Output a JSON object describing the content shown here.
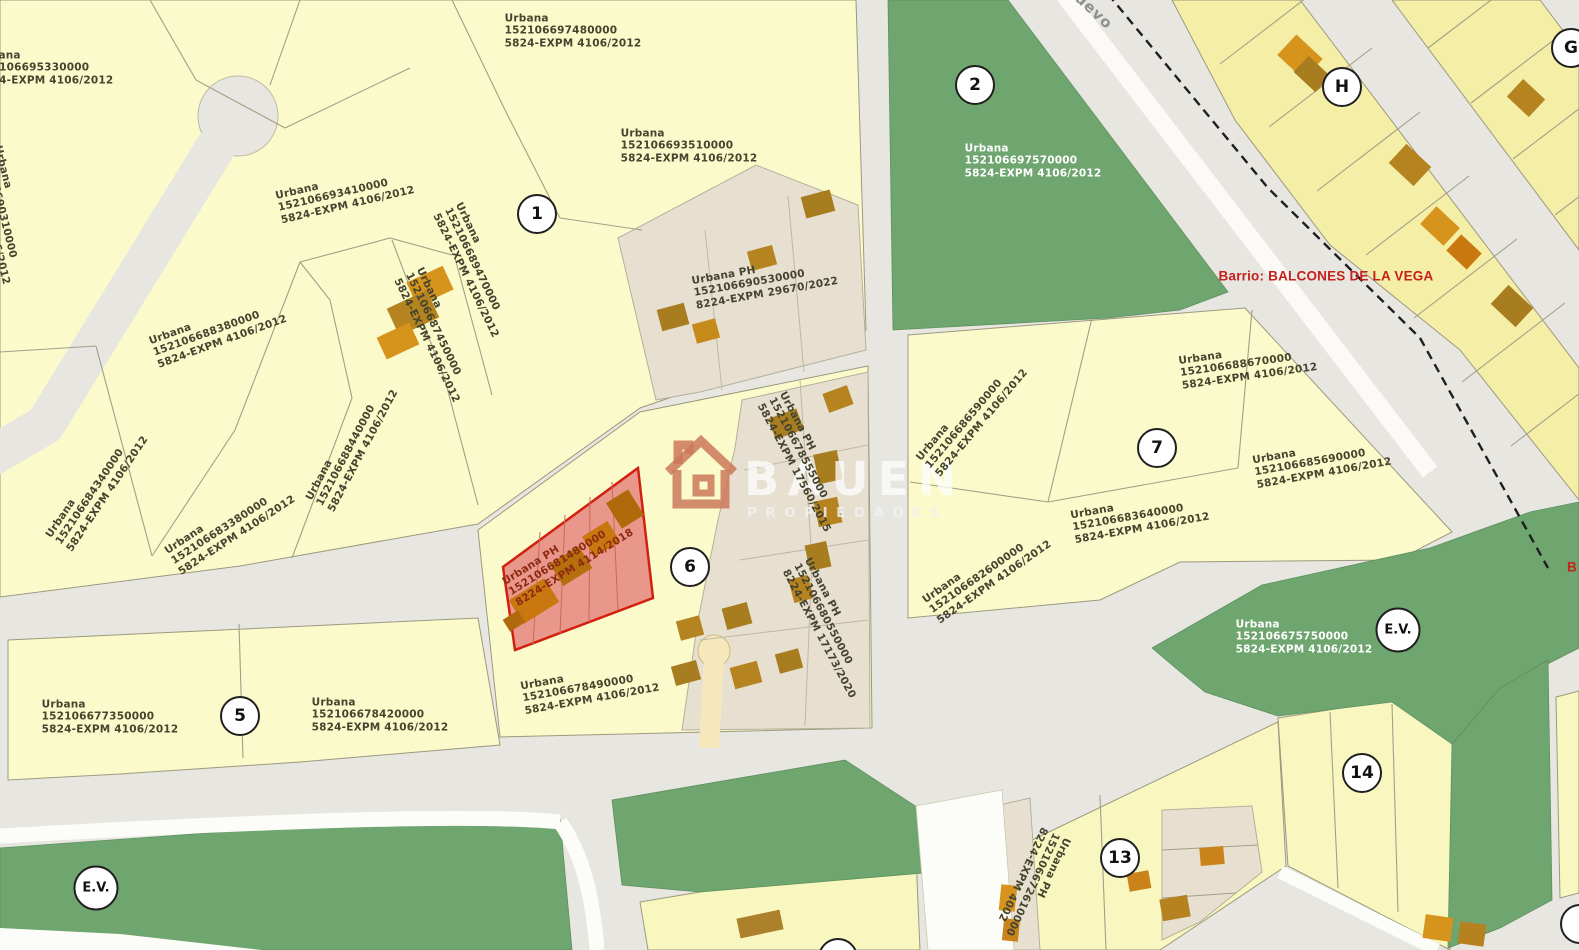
{
  "map": {
    "barrio_label": "Barrio: BALCONES DE LA VEGA",
    "barrio_label_partial": "B",
    "street_label_partial": "uevo",
    "watermark": {
      "brand": "BAUEN",
      "subtitle": "PROPIEDADES"
    },
    "highlight_color": "#d2200f",
    "parcel_fill": "#fbfacb",
    "green_fill": "#6fa56f",
    "circles": [
      {
        "label": "1"
      },
      {
        "label": "2"
      },
      {
        "label": "5"
      },
      {
        "label": "6"
      },
      {
        "label": "7"
      },
      {
        "label": "13"
      },
      {
        "label": "14"
      },
      {
        "label": "H"
      },
      {
        "label": "G"
      },
      {
        "label": "E.V."
      },
      {
        "label": "E.V."
      },
      {
        "label": ""
      },
      {
        "label": ""
      }
    ],
    "parcels": [
      {
        "l1": "Urbana",
        "l2": "152106695330000",
        "l3": "5824-EXPM 4106/2012"
      },
      {
        "l1": "Urbana",
        "l2": "152106690310000",
        "l3": "5824-EXPM 4106/2012"
      },
      {
        "l1": "5824-EXPM 4106/2012",
        "l2": "",
        "l3": ""
      },
      {
        "l1": "Urbana",
        "l2": "152106697480000",
        "l3": "5824-EXPM 4106/2012"
      },
      {
        "l1": "Urbana",
        "l2": "152106693510000",
        "l3": "5824-EXPM 4106/2012"
      },
      {
        "l1": "Urbana",
        "l2": "152106693410000",
        "l3": "5824-EXPM 4106/2012"
      },
      {
        "l1": "Urbana",
        "l2": "152106689470000",
        "l3": "5824-EXPM 4106/2012"
      },
      {
        "l1": "Urbana",
        "l2": "152106687450000",
        "l3": "5824-EXPM 4106/2012"
      },
      {
        "l1": "Urbana",
        "l2": "152106688380000",
        "l3": "5824-EXPM 4106/2012"
      },
      {
        "l1": "Urbana",
        "l2": "152106684340000",
        "l3": "5824-EXPM 4106/2012"
      },
      {
        "l1": "Urbana",
        "l2": "152106683380000",
        "l3": "5824-EXPM 4106/2012"
      },
      {
        "l1": "Urbana",
        "l2": "152106688440000",
        "l3": "5824-EXPM 4106/2012"
      },
      {
        "l1": "Urbana PH",
        "l2": "152106690530000",
        "l3": "8224-EXPM 29670/2022"
      },
      {
        "l1": "Urbana",
        "l2": "152106697570000",
        "l3": "5824-EXPM 4106/2012"
      },
      {
        "l1": "Urbana PH",
        "l2": "152106678555000",
        "l3": "5824-EXPM 17560/2015"
      },
      {
        "l1": "Urbana PH",
        "l2": "152106681480000",
        "l3": "8224-EXPM 4114/2018"
      },
      {
        "l1": "Urbana",
        "l2": "152106678490000",
        "l3": "5824-EXPM 4106/2012"
      },
      {
        "l1": "Urbana PH",
        "l2": "152106680550000",
        "l3": "8224-EXPM 17173/2020"
      },
      {
        "l1": "Urbana",
        "l2": "152106682600000",
        "l3": "5824-EXPM 4106/2012"
      },
      {
        "l1": "Urbana",
        "l2": "152106686590000",
        "l3": "5824-EXPM 4106/2012"
      },
      {
        "l1": "Urbana",
        "l2": "152106688670000",
        "l3": "5824-EXPM 4106/2012"
      },
      {
        "l1": "Urbana",
        "l2": "152106685690000",
        "l3": "5824-EXPM 4106/2012"
      },
      {
        "l1": "Urbana",
        "l2": "152106683640000",
        "l3": "5824-EXPM 4106/2012"
      },
      {
        "l1": "Urbana",
        "l2": "152106675750000",
        "l3": "5824-EXPM 4106/2012"
      },
      {
        "l1": "Urbana",
        "l2": "152106677350000",
        "l3": "5824-EXPM 4106/2012"
      },
      {
        "l1": "Urbana",
        "l2": "152106678420000",
        "l3": "5824-EXPM 4106/2012"
      },
      {
        "l1": "Urbana PH",
        "l2": "152106672610000",
        "l3": "8224-EXPM 4002"
      }
    ]
  }
}
